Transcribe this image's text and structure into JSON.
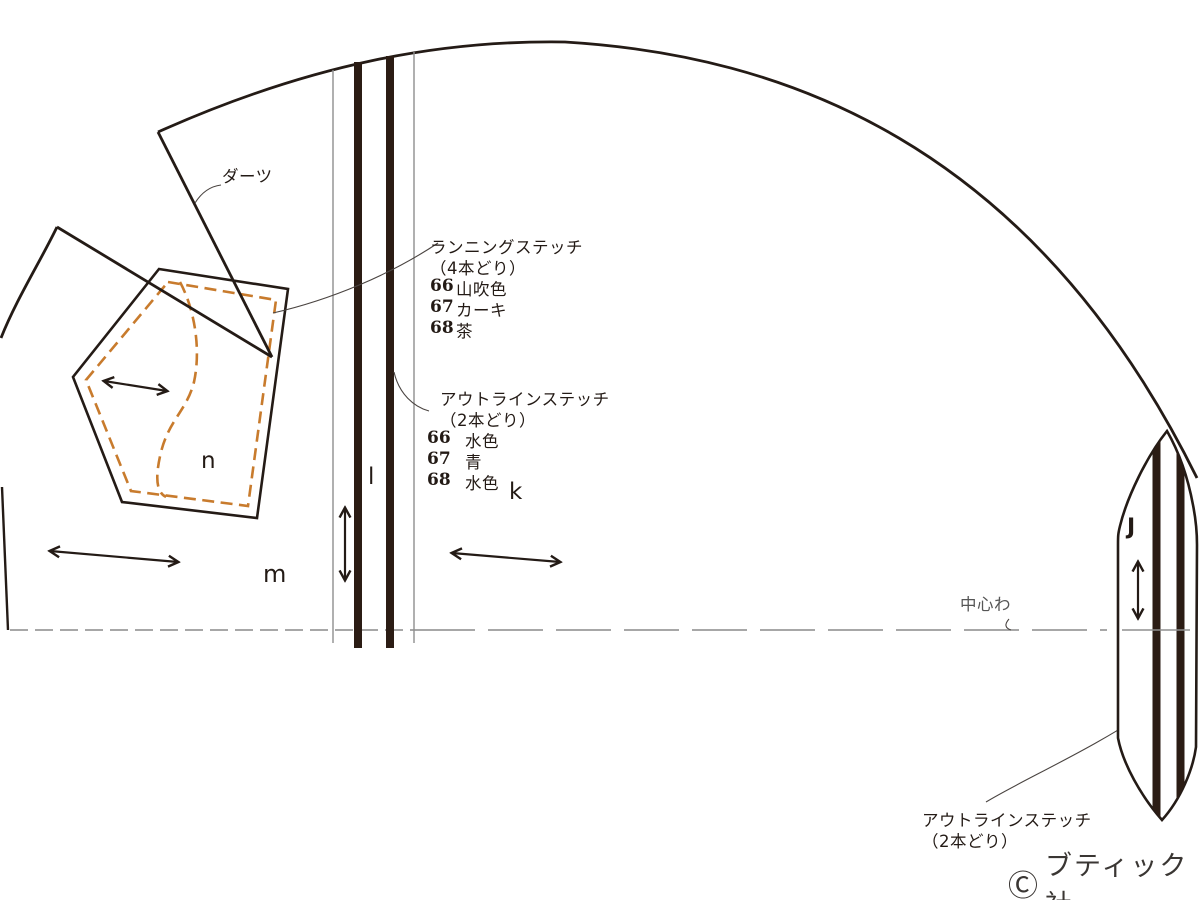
{
  "canvas": {
    "width": 1200,
    "height": 900,
    "background": "#ffffff"
  },
  "colors": {
    "line_black": "#241b16",
    "bar_dark": "#2b1c14",
    "thin_gray": "#8f8f8f",
    "dash_gray": "#8a8a8a",
    "stitch_orange": "#c87b2d",
    "leader_gray": "#4a4441",
    "muted_text": "#565656"
  },
  "labels": {
    "dart": "ダーツ",
    "center_fold": "中心わ"
  },
  "pieces": {
    "n": "n",
    "m": "m",
    "l": "l",
    "k": "k",
    "j": "J"
  },
  "running_stitch": {
    "title": "ランニングステッチ",
    "strands": "（4本どり）",
    "items": [
      {
        "num": "66",
        "color": "山吹色"
      },
      {
        "num": "67",
        "color": "カーキ"
      },
      {
        "num": "68",
        "color": "茶"
      }
    ]
  },
  "outline_stitch": {
    "title": "アウトラインステッチ",
    "strands": "（2本どり）",
    "items": [
      {
        "num": "66",
        "color": "水色"
      },
      {
        "num": "67",
        "color": "青"
      },
      {
        "num": "68",
        "color": "水色"
      }
    ]
  },
  "outline_stitch_bottom": {
    "title": "アウトラインステッチ",
    "strands": "（2本どり）"
  },
  "copyright": {
    "symbol": "Ⓒ",
    "name": "ブティック社"
  }
}
